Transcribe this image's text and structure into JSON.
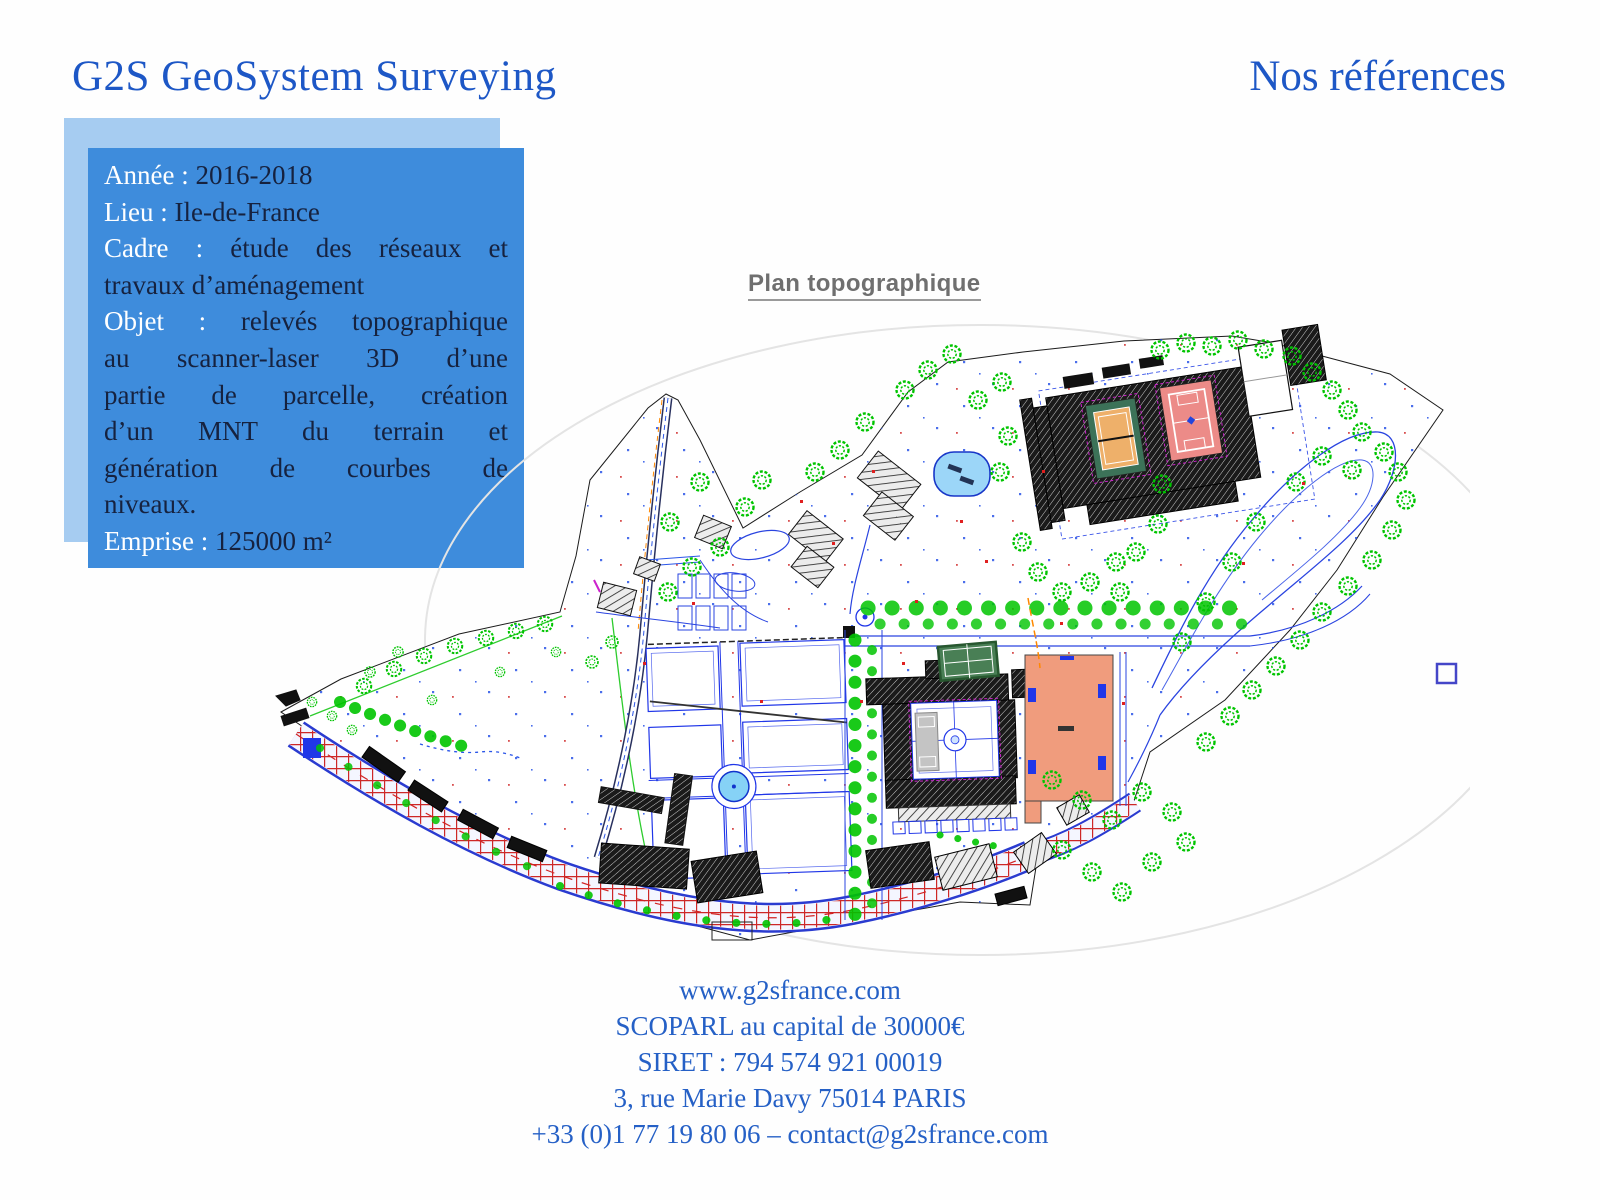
{
  "header": {
    "title": "G2S GeoSystem Surveying",
    "right_title": "Nos références"
  },
  "info_box": {
    "lines": [
      {
        "label": "Année :",
        "text": "2016-2018"
      },
      {
        "label": "Lieu :",
        "text": "Ile-de-France"
      },
      {
        "label": "Cadre :",
        "text": "étude des réseaux et",
        "justified": true
      },
      {
        "label": "",
        "text": "travaux d’aménagement"
      },
      {
        "label": "Objet :",
        "text": "relevés topographique",
        "justified": true
      },
      {
        "label": "",
        "text": "au scanner-laser 3D d’une",
        "justified": true
      },
      {
        "label": "",
        "text": "partie de parcelle, création",
        "justified": true
      },
      {
        "label": "",
        "text": "d’un MNT du terrain et",
        "justified": true
      },
      {
        "label": "",
        "text": "génération de courbes de",
        "justified": true
      },
      {
        "label": "",
        "text": "niveaux."
      },
      {
        "label": "Emprise :",
        "text": "125000 m²"
      }
    ]
  },
  "map": {
    "caption": "Plan topographique",
    "legend_square": "boundary-reference-square"
  },
  "footer": {
    "lines": [
      "www.g2sfrance.com",
      "SCOPARL au capital de 30000€",
      "SIRET : 794 574 921 00019",
      "3, rue Marie Davy 75014 PARIS",
      "+33 (0)1 77 19 80 06 – contact@g2sfrance.com"
    ]
  },
  "colors": {
    "title_blue": "#1d57c6",
    "footer_blue": "#2560c6",
    "box_blue": "#3e8cdc",
    "box_shadow_blue": "#a6ccf1",
    "box_label_white": "#ffffff",
    "box_value_navy": "#16223f",
    "caption_gray": "#6f6f6f",
    "map_green": "#00c400",
    "map_blue": "#2036e8",
    "map_red": "#cd2727",
    "salmon_building": "#f09c7d",
    "pool_blue": "#9cd6f8",
    "court_green": "#3c7258",
    "court_orange": "#eeb06a",
    "court_salmon": "#ec8b88"
  }
}
